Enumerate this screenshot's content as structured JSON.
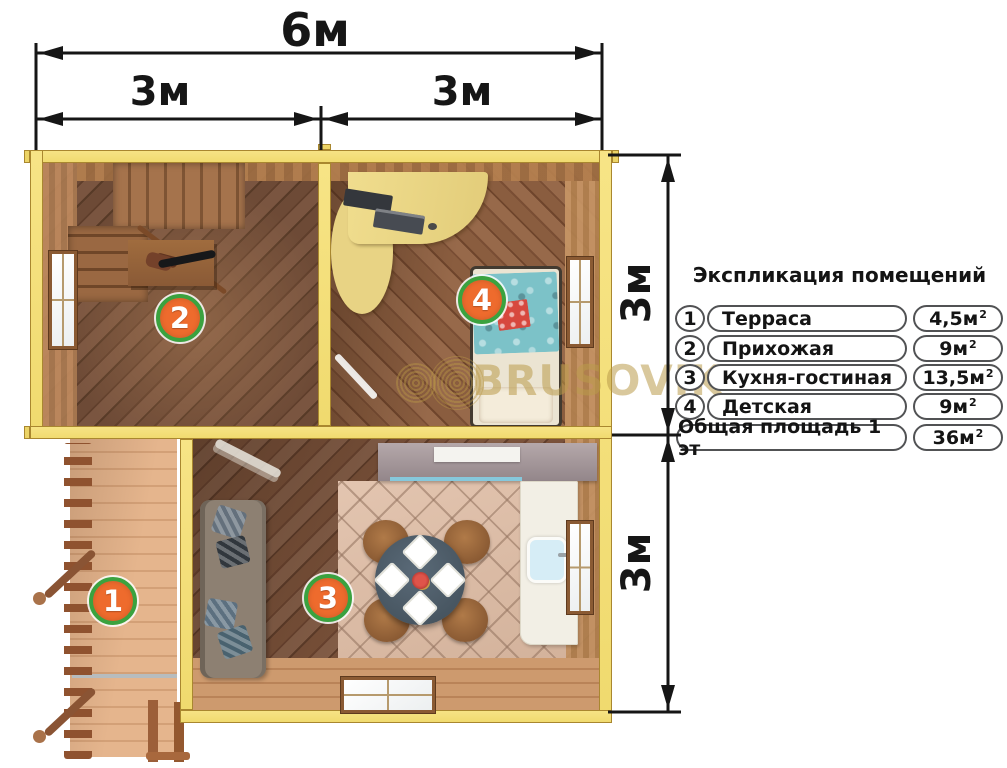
{
  "dimensions": {
    "width_total": "6м",
    "width_left": "3м",
    "width_right": "3м",
    "height_top": "3м",
    "height_bottom": "3м"
  },
  "legend": {
    "title": "Экспликация помещений",
    "rows": [
      {
        "num": "1",
        "name": "Терраса",
        "area": "4,5м",
        "sup": "2"
      },
      {
        "num": "2",
        "name": "Прихожая",
        "area": "9м",
        "sup": "2"
      },
      {
        "num": "3",
        "name": "Кухня-гостиная",
        "area": "13,5м",
        "sup": "2"
      },
      {
        "num": "4",
        "name": "Детская",
        "area": "9м",
        "sup": "2"
      }
    ],
    "total_row": {
      "name": "Общая площадь 1 эт",
      "area": "36м",
      "sup": "2"
    }
  },
  "markers": {
    "terrace": "1",
    "hallway": "2",
    "kitchen_living": "3",
    "kids_room": "4"
  },
  "watermark": {
    "text": "BRUSOVIK"
  },
  "colors": {
    "wall_yellow": "#f5e17d",
    "marker_fill": "#ee6b2d",
    "marker_ring": "#3ba23f",
    "dimension_ink": "#161616",
    "watermark_gold": "#b99a50"
  }
}
